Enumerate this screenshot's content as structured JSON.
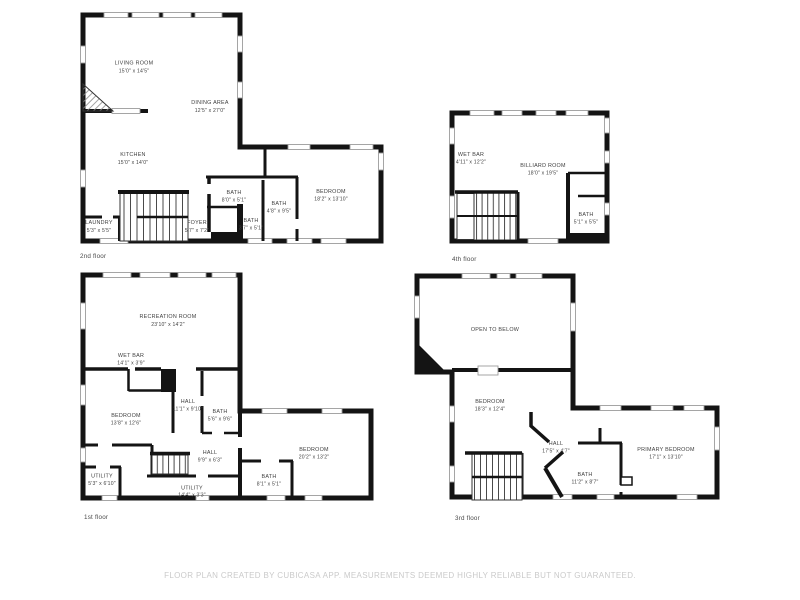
{
  "colors": {
    "background": "#ffffff",
    "wall": "#141414",
    "room_text": "#3f3f3f",
    "floor_label_text": "#4a4a4a",
    "window_outline": "#9c9c9c",
    "footer_text": "#cacaca"
  },
  "floors": {
    "floor2": {
      "label": "2nd floor",
      "rooms": [
        {
          "name": "LIVING ROOM",
          "dims": "15'0\" x 14'5\""
        },
        {
          "name": "DINING AREA",
          "dims": "12'5\" x 27'0\""
        },
        {
          "name": "KITCHEN",
          "dims": "15'0\" x 14'0\""
        },
        {
          "name": "LAUNDRY",
          "dims": "5'3\" x 5'5\""
        },
        {
          "name": "FOYER",
          "dims": "5'7\" x 7'2\""
        },
        {
          "name": "BATH",
          "dims": "8'0\" x 5'1\""
        },
        {
          "name": "BATH",
          "dims": "4'8\" x 9'5\""
        },
        {
          "name": "BATH",
          "dims": "3'7\" x 5'1\""
        },
        {
          "name": "BEDROOM",
          "dims": "18'2\" x 13'10\""
        }
      ]
    },
    "floor4": {
      "label": "4th floor",
      "rooms": [
        {
          "name": "WET BAR",
          "dims": "4'11\" x 12'2\""
        },
        {
          "name": "BILLIARD ROOM",
          "dims": "18'0\" x 19'5\""
        },
        {
          "name": "BATH",
          "dims": "5'1\" x 5'5\""
        }
      ]
    },
    "floor1": {
      "label": "1st floor",
      "rooms": [
        {
          "name": "RECREATION ROOM",
          "dims": "23'10\" x 14'2\""
        },
        {
          "name": "WET BAR",
          "dims": "14'1\" x 3'9\""
        },
        {
          "name": "BEDROOM",
          "dims": "13'8\" x 12'6\""
        },
        {
          "name": "HALL",
          "dims": "11'1\" x 9'10\""
        },
        {
          "name": "BATH",
          "dims": "5'6\" x 9'6\""
        },
        {
          "name": "HALL",
          "dims": "9'9\" x 6'3\""
        },
        {
          "name": "UTILITY",
          "dims": "5'3\" x 6'10\""
        },
        {
          "name": "UTILITY",
          "dims": "14'4\" x 3'3\""
        },
        {
          "name": "BEDROOM",
          "dims": "20'2\" x 13'2\""
        },
        {
          "name": "BATH",
          "dims": "8'1\" x 5'1\""
        }
      ]
    },
    "floor3": {
      "label": "3rd floor",
      "rooms": [
        {
          "name": "OPEN TO BELOW",
          "dims": ""
        },
        {
          "name": "BEDROOM",
          "dims": "18'3\" x 12'4\""
        },
        {
          "name": "HALL",
          "dims": "17'5\" x 4'7\""
        },
        {
          "name": "BATH",
          "dims": "11'2\" x 8'7\""
        },
        {
          "name": "PRIMARY BEDROOM",
          "dims": "17'1\" x 13'10\""
        }
      ]
    }
  },
  "footer": {
    "disclaimer": "FLOOR PLAN CREATED BY CUBICASA APP. MEASUREMENTS DEEMED HIGHLY RELIABLE BUT NOT GUARANTEED."
  }
}
